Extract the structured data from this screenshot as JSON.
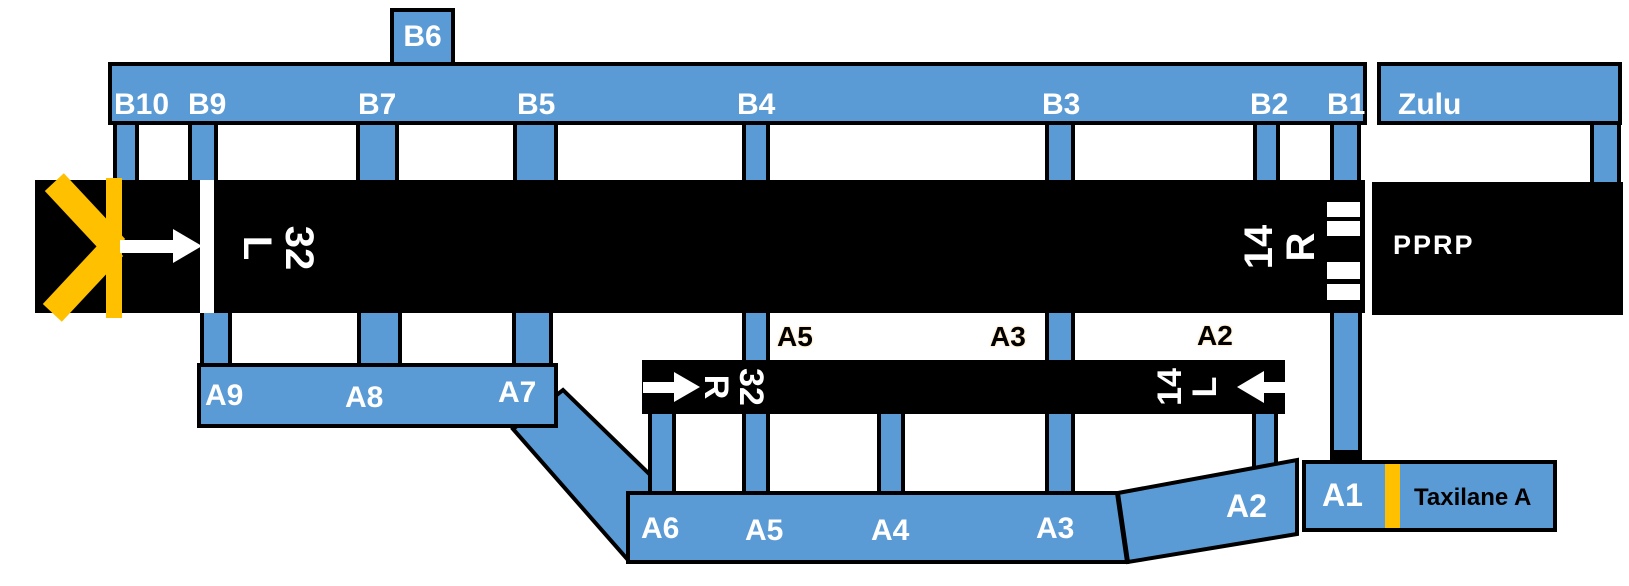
{
  "colors": {
    "taxiway_blue": "#5B9BD5",
    "marking_yellow": "#FFC000",
    "runway_black": "#000000",
    "outline_black": "#000000",
    "label_white": "#FFFFFF"
  },
  "b6_stub": {
    "label": "B6"
  },
  "b_bar": {
    "labels": [
      {
        "text": "B10"
      },
      {
        "text": "B9"
      },
      {
        "text": "B7"
      },
      {
        "text": "B5"
      },
      {
        "text": "B4"
      },
      {
        "text": "B3"
      },
      {
        "text": "B2"
      },
      {
        "text": "B1"
      }
    ]
  },
  "zulu": {
    "label": "Zulu"
  },
  "pprp": {
    "label": "PPRP"
  },
  "runway_north": {
    "left_end": {
      "number": "32",
      "letter": "L"
    },
    "right_end": {
      "number": "14",
      "letter": "R"
    }
  },
  "runway_south": {
    "left_end": {
      "number": "32",
      "letter": "R"
    },
    "right_end": {
      "number": "14",
      "letter": "L"
    }
  },
  "a_bar_upper": {
    "labels": [
      {
        "text": "A9"
      },
      {
        "text": "A8"
      },
      {
        "text": "A7"
      }
    ]
  },
  "midfield_labels": [
    {
      "text": "A5"
    },
    {
      "text": "A3"
    },
    {
      "text": "A2"
    }
  ],
  "a_bar_lower": {
    "labels": [
      {
        "text": "A6"
      },
      {
        "text": "A5"
      },
      {
        "text": "A4"
      },
      {
        "text": "A3"
      }
    ]
  },
  "a2_segment": {
    "label": "A2"
  },
  "a1_segment": {
    "label": "A1"
  },
  "taxilane": {
    "label": "Taxilane A"
  }
}
